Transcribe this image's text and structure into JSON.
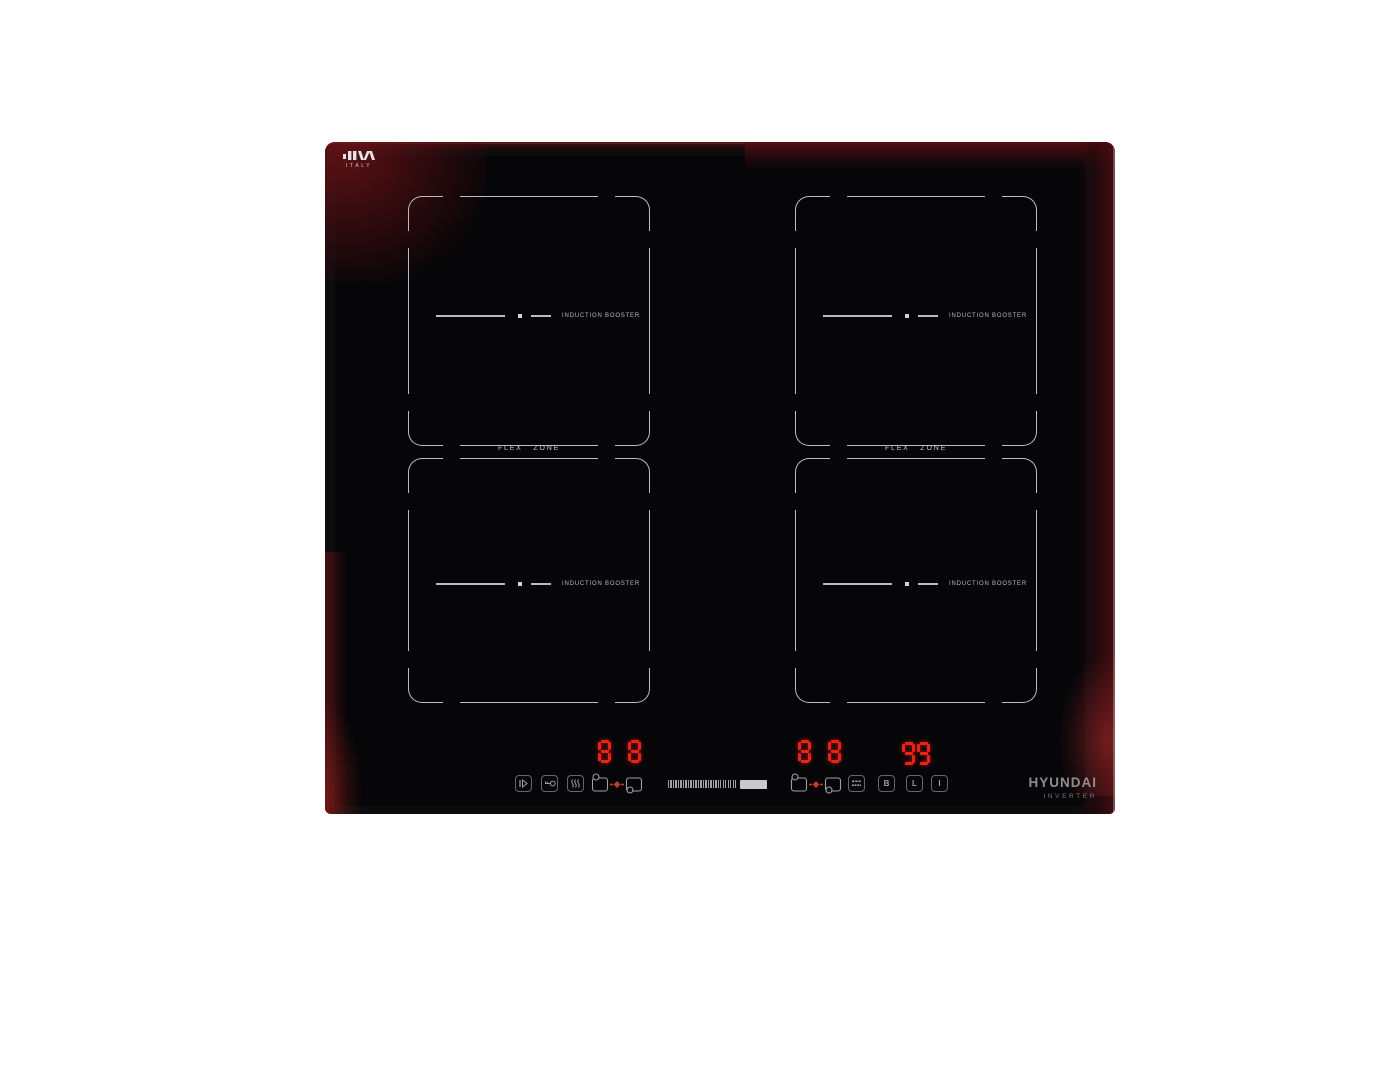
{
  "colors": {
    "led": "#ef2118",
    "line": "#b9bdc1",
    "icon": "#9ba1a6"
  },
  "glass_logo": {
    "country": "ITALY"
  },
  "flex_zones": {
    "left": "FLEX ZONE",
    "right": "FLEX ZONE"
  },
  "zones": [
    {
      "name": "rear-left",
      "booster_label": "INDUCTION BOOSTER"
    },
    {
      "name": "rear-right",
      "booster_label": "INDUCTION BOOSTER"
    },
    {
      "name": "front-left",
      "booster_label": "INDUCTION BOOSTER"
    },
    {
      "name": "front-right",
      "booster_label": "INDUCTION BOOSTER"
    }
  ],
  "displays": {
    "left_zone_levels": "8 8",
    "right_zone_levels": "8 8",
    "timer": "99"
  },
  "controls": {
    "buttons": {
      "boost": "B",
      "lock": "L",
      "power": "I"
    },
    "slider": {
      "ticks": 28,
      "filled": true
    },
    "icons": [
      "pause-icon",
      "key-icon",
      "keep-warm-icon",
      "bridge-zones-icon",
      "auto-menu-icon"
    ]
  },
  "brand": {
    "name": "HYUNDAI",
    "technology": "INVERTER"
  }
}
